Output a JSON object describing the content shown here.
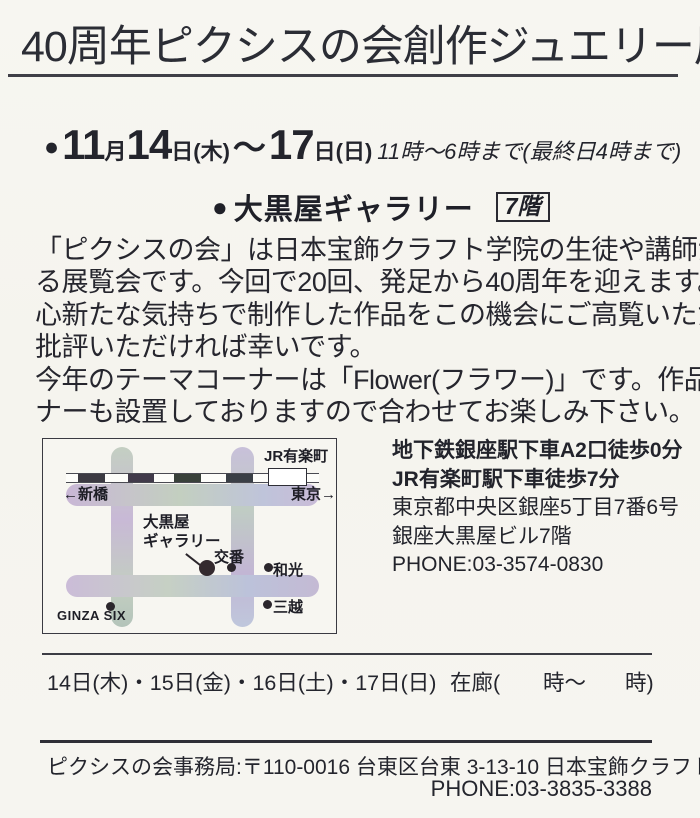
{
  "page": {
    "background": "#f6f5f0",
    "ink": "#26262e"
  },
  "title": {
    "text": "40周年ピクシスの会創作ジュエリー展"
  },
  "schedule": {
    "bullet": "●",
    "month": "11",
    "month_unit": "月",
    "start_day": "14",
    "start_day_unit": "日(木)",
    "tilde": "〜",
    "end_day": "17",
    "end_day_unit": "日(日)",
    "hours": "11時〜6時まで(最終日4時まで)"
  },
  "venue": {
    "bullet": "●",
    "name": "大黒屋ギャラリー",
    "floor": "7階"
  },
  "intro": {
    "lines": [
      "「ピクシスの会」は日本宝飾クラフト学院の生徒や講師が開催す",
      "る展覧会です。今回で20回、発足から40周年を迎えます。",
      "心新たな気持ちで制作した作品をこの機会にご高覧いただき、ご",
      "批評いただければ幸いです。",
      "今年のテーマコーナーは「Flower(フラワー)」です。作品販売コー",
      "ナーも設置しておりますので合わせてお楽しみ下さい。"
    ]
  },
  "map": {
    "station_line_label": "JR有楽町",
    "toward_left": "←新橋",
    "toward_right": "東京→",
    "gallery_line1": "大黒屋",
    "gallery_line2": "ギャラリー",
    "police_box": "交番",
    "wako": "和光",
    "mitsukoshi": "三越",
    "ginza_six": "GINZA SIX"
  },
  "access": {
    "bold_lines": [
      "地下鉄銀座駅下車A2口徒歩0分",
      "JR有楽町駅下車徒歩7分"
    ],
    "lines": [
      "東京都中央区銀座5丁目7番6号",
      "銀座大黒屋ビル7階",
      "PHONE:03-3574-0830"
    ]
  },
  "attendance": {
    "days": "14日(木)・15日(金)・16日(土)・17日(日)",
    "zairo_open": "在廊(",
    "zairo_mid": "時〜",
    "zairo_close": "時)"
  },
  "footer": {
    "office": "ピクシスの会事務局:〒110-0016 台東区台東 3-13-10 日本宝飾クラフト学院内",
    "phone": "PHONE:03-3835-3388"
  }
}
